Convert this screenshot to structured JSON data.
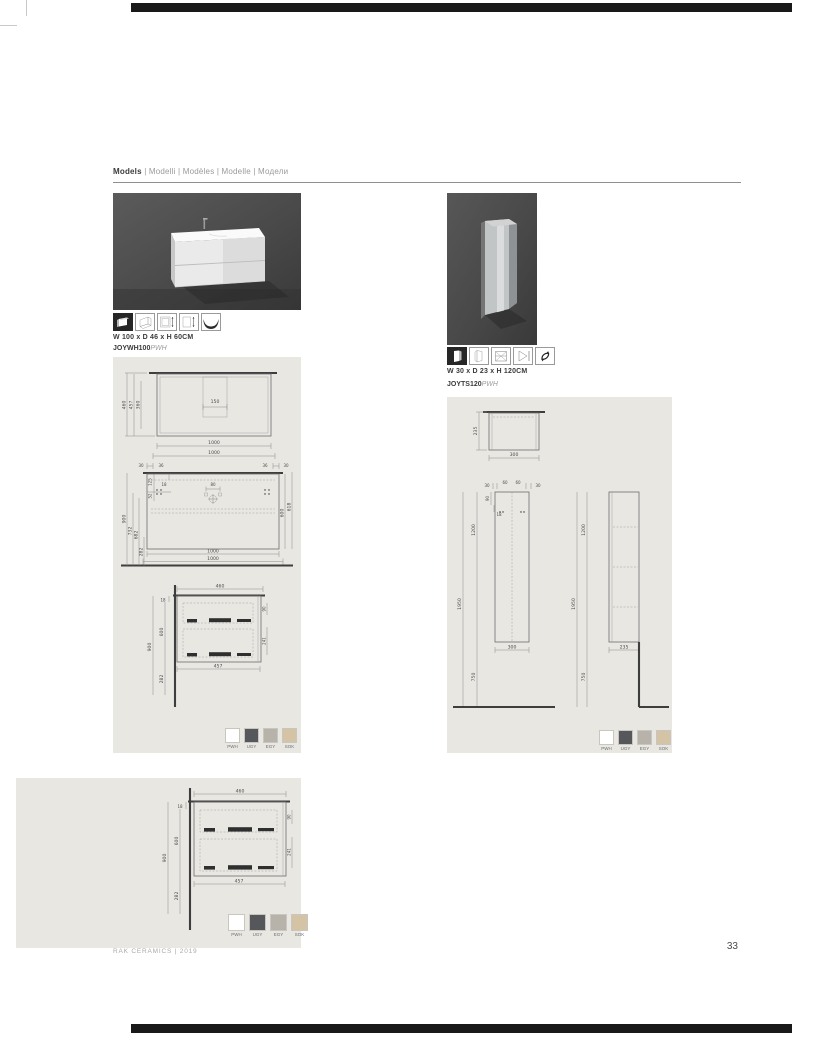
{
  "header": {
    "title_bold": "Models",
    "title_rest": " | Modelli | Modèles | Modelle | Модели"
  },
  "left_product": {
    "size": "W 100 x D 46 x H 60CM",
    "code": "JOYWH100",
    "finish": "PWH",
    "icons": [
      "unit-3d",
      "unit-perspective",
      "front-dimensions",
      "side-dimensions",
      "basin-profile"
    ]
  },
  "right_product": {
    "size": "W 30 x D 23 x H 120CM",
    "code": "JOYTS120",
    "finish": "PWH",
    "icons": [
      "unit-3d",
      "unit-perspective",
      "shelf-detail",
      "side-dimensions",
      "reversible-door"
    ]
  },
  "swatches": [
    {
      "label": "PWH",
      "color": "#ffffff"
    },
    {
      "label": "UGY",
      "color": "#56575b"
    },
    {
      "label": "EGY",
      "color": "#b7b2aa"
    },
    {
      "label": "SOK",
      "color": "#d4c3a4"
    }
  ],
  "drawings": {
    "vanity_top": {
      "h1": "460",
      "h2": "457",
      "h3": "360",
      "notch": "150",
      "w1": "1000",
      "w2": "1000"
    },
    "vanity_front": {
      "off_l1": "30",
      "off_l2": "36",
      "off_r1": "36",
      "off_r2": "30",
      "tap": "80",
      "t18": "18",
      "t125": "125",
      "t52": "52",
      "h900": "900",
      "h732": "732",
      "h682": "682",
      "h282": "282",
      "h600": "600",
      "h618": "618",
      "w1": "1000",
      "w2": "1000"
    },
    "vanity_side": {
      "d460": "460",
      "t18": "18",
      "h600": "600",
      "h900": "900",
      "h282": "282",
      "r90": "90",
      "r241": "241",
      "d457": "457"
    },
    "tall_top": {
      "d235": "235",
      "w300": "300"
    },
    "tall_front": {
      "off_l": "30",
      "c60a": "60",
      "c60b": "60",
      "off_r": "30",
      "t90": "90",
      "t18": "18",
      "h1200": "1200",
      "h1950": "1950",
      "h750": "750",
      "w300": "300"
    },
    "tall_side": {
      "h1200": "1200",
      "h1950": "1950",
      "h750": "750",
      "d235": "235"
    }
  },
  "footer": {
    "brand": "RAK CERAMICS | 2019",
    "page": "33"
  }
}
